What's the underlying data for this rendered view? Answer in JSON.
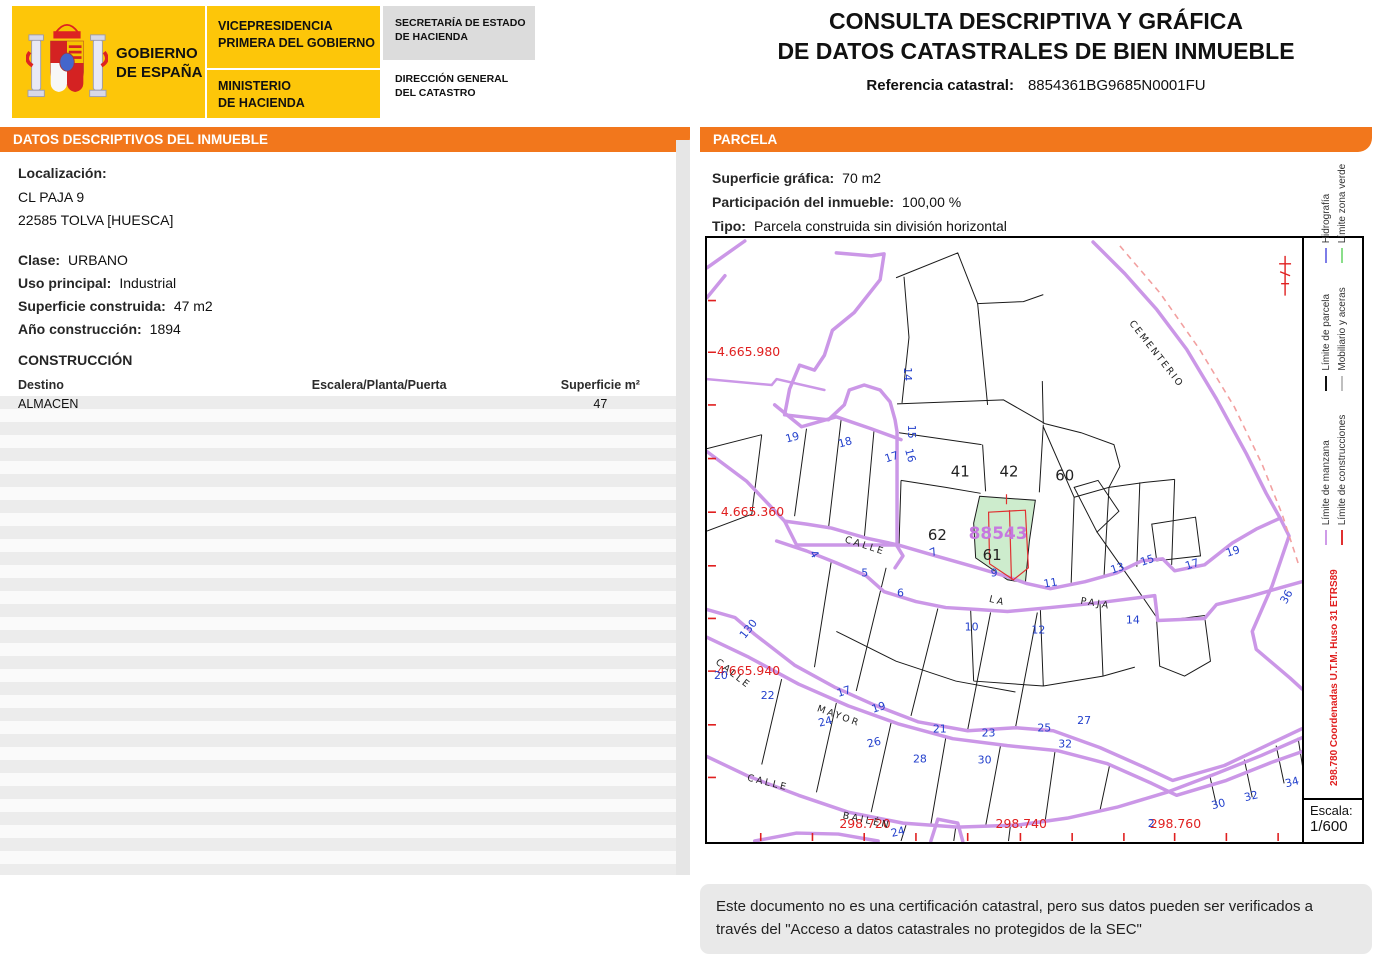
{
  "header": {
    "logo": {
      "gobierno_line1": "GOBIERNO",
      "gobierno_line2": "DE ESPAÑA",
      "vice_line1": "VICEPRESIDENCIA",
      "vice_line2": "PRIMERA DEL GOBIERNO",
      "min_line1": "MINISTERIO",
      "min_line2": "DE HACIENDA",
      "sec_line1": "SECRETARÍA DE ESTADO",
      "sec_line2": "DE HACIENDA",
      "dir_line1": "DIRECCIÓN GENERAL",
      "dir_line2": "DEL CATASTRO"
    },
    "title_line1": "CONSULTA DESCRIPTIVA Y GRÁFICA",
    "title_line2": "DE DATOS CATASTRALES DE BIEN INMUEBLE",
    "ref_label": "Referencia catastral:",
    "ref_value": "8854361BG9685N0001FU"
  },
  "left_panel": {
    "header": "DATOS DESCRIPTIVOS DEL INMUEBLE",
    "localizacion_label": "Localización:",
    "address_line1": "CL PAJA 9",
    "address_line2": "22585 TOLVA [HUESCA]",
    "clase_label": "Clase:",
    "clase_value": "URBANO",
    "uso_label": "Uso principal:",
    "uso_value": "Industrial",
    "superficie_label": "Superficie construida:",
    "superficie_value": "47 m2",
    "anio_label": "Año construcción:",
    "anio_value": "1894",
    "construccion_title": "CONSTRUCCIÓN",
    "table": {
      "headers": [
        "Destino",
        "Escalera/Planta/Puerta",
        "Superficie m²"
      ],
      "rows": [
        [
          "ALMACEN",
          "",
          "47"
        ]
      ]
    }
  },
  "right_panel": {
    "header": "PARCELA",
    "superficie_label": "Superficie gráfica:",
    "superficie_value": "70 m2",
    "participacion_label": "Participación del inmueble:",
    "participacion_value": "100,00 %",
    "tipo_label": "Tipo:",
    "tipo_value": "Parcela construida sin división horizontal"
  },
  "map": {
    "palette": {
      "red": "#e02020",
      "blue": "#2340cc",
      "black": "#222222",
      "purple": "#c678e0"
    },
    "highlight_parcel_fill": "#cdeccd",
    "labels": [
      {
        "t": "4.665.980",
        "x": 10,
        "y": 119,
        "c": "red",
        "s": 12.5
      },
      {
        "t": "4.665.360",
        "x": 14,
        "y": 280,
        "c": "red",
        "s": 12.5
      },
      {
        "t": "4.665.940",
        "x": 10,
        "y": 440,
        "c": "red",
        "s": 12.5
      },
      {
        "t": "298.720",
        "x": 133,
        "y": 594,
        "c": "red",
        "s": 12.5
      },
      {
        "t": "298.740",
        "x": 290,
        "y": 594,
        "c": "red",
        "s": 12.5
      },
      {
        "t": "298.760",
        "x": 445,
        "y": 594,
        "c": "red",
        "s": 12.5
      },
      {
        "t": "41",
        "x": 245,
        "y": 240,
        "c": "black",
        "s": 15
      },
      {
        "t": "42",
        "x": 294,
        "y": 240,
        "c": "black",
        "s": 15
      },
      {
        "t": "60",
        "x": 350,
        "y": 244,
        "c": "black",
        "s": 15
      },
      {
        "t": "62",
        "x": 222,
        "y": 304,
        "c": "black",
        "s": 15
      },
      {
        "t": "61",
        "x": 277,
        "y": 324,
        "c": "black",
        "s": 15
      },
      {
        "t": "88543",
        "x": 263,
        "y": 303,
        "c": "purple",
        "s": 17,
        "b": 1
      },
      {
        "t": "CALLE",
        "x": 138,
        "y": 306,
        "c": "black",
        "s": 9.5,
        "sp": 2.5,
        "r": 18
      },
      {
        "t": "LA",
        "x": 283,
        "y": 366,
        "c": "black",
        "s": 9.5,
        "sp": 2.5,
        "r": 14
      },
      {
        "t": "PAJA",
        "x": 375,
        "y": 368,
        "c": "black",
        "s": 9.5,
        "sp": 2.5,
        "r": 10
      },
      {
        "t": "CALLE",
        "x": 8,
        "y": 428,
        "c": "black",
        "s": 9.5,
        "sp": 2.5,
        "r": 38
      },
      {
        "t": "MAYOR",
        "x": 110,
        "y": 476,
        "c": "black",
        "s": 9.5,
        "sp": 2.5,
        "r": 20
      },
      {
        "t": "CALLE",
        "x": 40,
        "y": 546,
        "c": "black",
        "s": 9.5,
        "sp": 2.5,
        "r": 14
      },
      {
        "t": "BAILÉN",
        "x": 136,
        "y": 584,
        "c": "black",
        "s": 9.5,
        "sp": 2.5,
        "r": 12
      },
      {
        "t": "CEMENTERIO",
        "x": 424,
        "y": 86,
        "c": "black",
        "s": 9.5,
        "sp": 2,
        "r": 52
      },
      {
        "t": "14",
        "x": 198,
        "y": 130,
        "r": 90
      },
      {
        "t": "15",
        "x": 202,
        "y": 188,
        "r": 90
      },
      {
        "t": "16",
        "x": 199,
        "y": 213,
        "r": 75
      },
      {
        "t": "17",
        "x": 180,
        "y": 226,
        "r": -18
      },
      {
        "t": "18",
        "x": 133,
        "y": 211,
        "r": -15
      },
      {
        "t": "19",
        "x": 80,
        "y": 206,
        "r": -15
      },
      {
        "t": "7",
        "x": 226,
        "y": 321,
        "r": -25
      },
      {
        "t": "9",
        "x": 285,
        "y": 341
      },
      {
        "t": "11",
        "x": 339,
        "y": 352,
        "r": -10
      },
      {
        "t": "13",
        "x": 407,
        "y": 338,
        "r": -18
      },
      {
        "t": "15",
        "x": 437,
        "y": 330,
        "r": -18
      },
      {
        "t": "17",
        "x": 482,
        "y": 334,
        "r": -18
      },
      {
        "t": "19",
        "x": 523,
        "y": 321,
        "r": -18
      },
      {
        "t": "4",
        "x": 103,
        "y": 317,
        "r": 60
      },
      {
        "t": "5",
        "x": 155,
        "y": 341
      },
      {
        "t": "6",
        "x": 191,
        "y": 361
      },
      {
        "t": "10",
        "x": 259,
        "y": 395
      },
      {
        "t": "12",
        "x": 326,
        "y": 398
      },
      {
        "t": "14",
        "x": 421,
        "y": 388
      },
      {
        "t": "130",
        "x": 38,
        "y": 404,
        "r": -52
      },
      {
        "t": "20",
        "x": 7,
        "y": 444
      },
      {
        "t": "22",
        "x": 54,
        "y": 464
      },
      {
        "t": "17",
        "x": 132,
        "y": 462,
        "r": -18
      },
      {
        "t": "19",
        "x": 167,
        "y": 478,
        "r": -18
      },
      {
        "t": "24",
        "x": 113,
        "y": 492,
        "r": -14
      },
      {
        "t": "26",
        "x": 162,
        "y": 513,
        "r": -14
      },
      {
        "t": "21",
        "x": 227,
        "y": 498
      },
      {
        "t": "23",
        "x": 276,
        "y": 502
      },
      {
        "t": "25",
        "x": 332,
        "y": 497
      },
      {
        "t": "27",
        "x": 372,
        "y": 489
      },
      {
        "t": "28",
        "x": 207,
        "y": 528
      },
      {
        "t": "30",
        "x": 272,
        "y": 529
      },
      {
        "t": "32",
        "x": 353,
        "y": 513
      },
      {
        "t": "2",
        "x": 443,
        "y": 593
      },
      {
        "t": "24",
        "x": 186,
        "y": 603,
        "r": -14
      },
      {
        "t": "30",
        "x": 508,
        "y": 575,
        "r": -14
      },
      {
        "t": "32",
        "x": 541,
        "y": 567,
        "r": -14
      },
      {
        "t": "34",
        "x": 582,
        "y": 553,
        "r": -14
      },
      {
        "t": "36",
        "x": 582,
        "y": 369,
        "r": -60
      }
    ],
    "legend": {
      "items": [
        {
          "label": "Hidrografía",
          "color": "#7d7de8"
        },
        {
          "label": "Límite zona verde",
          "color": "#8ade8a"
        },
        {
          "label": "Límite de parcela",
          "color": "#111111"
        },
        {
          "label": "Mobiliario y aceras",
          "color": "#bfbfbf"
        },
        {
          "label": "Límite de manzana",
          "color": "#cf9be8"
        },
        {
          "label": "Límite de construcciones",
          "color": "#e03030"
        }
      ],
      "coords_note": "298.780 Coordenadas U.T.M. Huso 31 ETRS89",
      "escala_label": "Escala:",
      "escala_value": "1/600"
    }
  },
  "footer": {
    "disclaimer_line1": "Este documento no es una certificación catastral, pero sus datos pueden ser verificados a",
    "disclaimer_line2": "través del \"Acceso a datos catastrales no protegidos de la SEC\""
  }
}
